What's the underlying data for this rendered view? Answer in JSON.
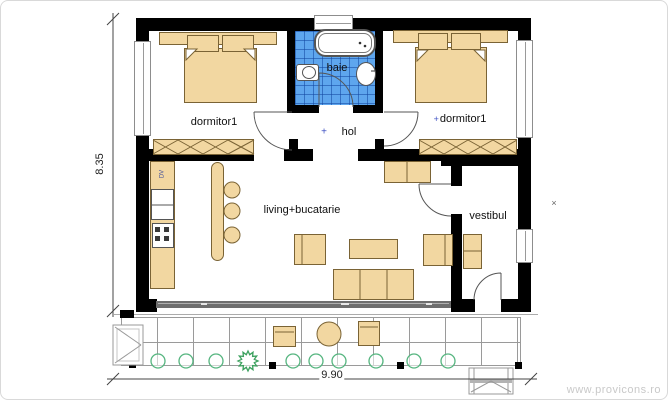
{
  "plan": {
    "watermark": "www.provicons.ro",
    "dimensions": {
      "vertical_m": "8.35",
      "horizontal_m": "9.90"
    },
    "rooms": {
      "bedroom_left": {
        "label": "dormitor1"
      },
      "bathroom": {
        "label": "baie"
      },
      "hall": {
        "label": "hol",
        "marker": "+"
      },
      "bedroom_right": {
        "label": "dormitor1",
        "marker": "+"
      },
      "living_kitchen": {
        "label": "living+bucatarie"
      },
      "vestibule": {
        "label": "vestibul"
      }
    },
    "kitchen": {
      "appliance_label": "DV"
    },
    "site_marker": "×",
    "colors": {
      "wall_black": "#000000",
      "furniture_fill": "#f2d7a1",
      "furniture_outline": "#7a6335",
      "bathroom_tile_blue": "#5ea6ee",
      "plant_green": "#55b57f",
      "glass_door_gray": "#6e6e6e",
      "terrace_line_gray": "#9a9a9a",
      "watermark_gray": "#c9c9c9"
    }
  }
}
